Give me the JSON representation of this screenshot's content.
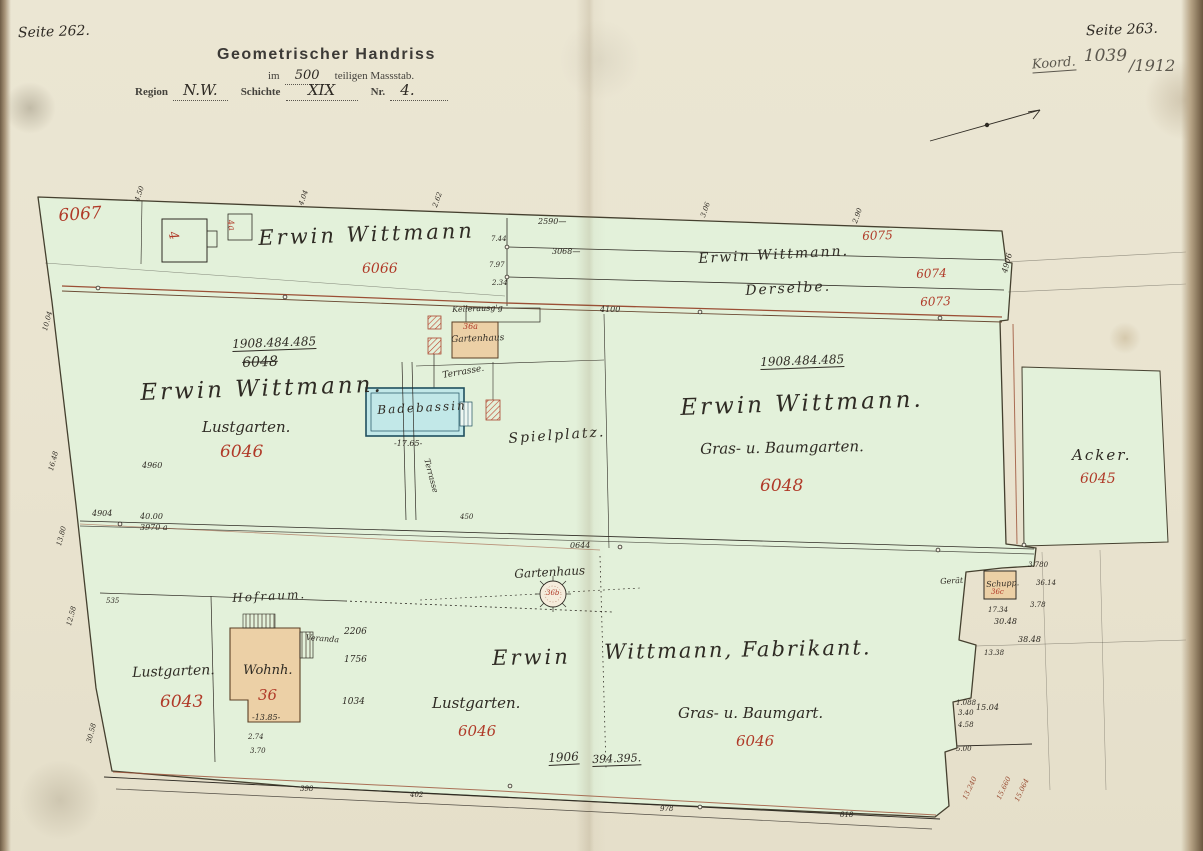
{
  "page": {
    "seite_left": "Seite 262.",
    "seite_right": "Seite 263.",
    "title": "Geometrischer Handriss",
    "subtitle_pre": "im",
    "subtitle_value": "500",
    "subtitle_post": "teiligen Massstab.",
    "region_label": "Region",
    "region_value": "N.W.",
    "schichte_label": "Schichte",
    "schichte_value": "XIX",
    "nr_label": "Nr.",
    "nr_value": "4.",
    "koord_label": "Koord.",
    "koord_num": "1039",
    "koord_denom": "/1912"
  },
  "colors": {
    "ink": "#2f2b24",
    "red": "#b03a28",
    "sepia": "#9b4f35",
    "pencil": "#5b574d",
    "green": "#e3f1da",
    "pool": "#c2e8e8",
    "tan": "#ecd0a6"
  },
  "map": {
    "north_arrow": "north-arrow",
    "labels": [
      {
        "t": "6067",
        "x": 58,
        "y": 208,
        "fs": 17,
        "c": "red",
        "r": -4
      },
      {
        "t": "4",
        "x": 178,
        "y": 230,
        "fs": 13,
        "c": "red",
        "r": 75
      },
      {
        "t": "4a",
        "x": 233,
        "y": 219,
        "fs": 9,
        "c": "red",
        "r": 78
      },
      {
        "t": "Erwin Wittmann",
        "x": 258,
        "y": 228,
        "fs": 21,
        "c": "ink",
        "r": -2,
        "ls": 3
      },
      {
        "t": "6066",
        "x": 362,
        "y": 262,
        "fs": 14,
        "c": "red"
      },
      {
        "t": "6075",
        "x": 862,
        "y": 230,
        "fs": 12,
        "c": "red",
        "r": -2
      },
      {
        "t": "Erwin Wittmann.",
        "x": 698,
        "y": 252,
        "fs": 14,
        "c": "ink",
        "r": -3,
        "ls": 2
      },
      {
        "t": "6074",
        "x": 916,
        "y": 268,
        "fs": 12,
        "c": "red",
        "r": -2
      },
      {
        "t": "Derselbe.",
        "x": 745,
        "y": 284,
        "fs": 14,
        "c": "ink",
        "r": -3,
        "ls": 2
      },
      {
        "t": "6073",
        "x": 920,
        "y": 296,
        "fs": 12,
        "c": "red",
        "r": -2
      },
      {
        "t": "2590—",
        "x": 538,
        "y": 218,
        "fs": 8,
        "c": "ink"
      },
      {
        "t": "3068—",
        "x": 552,
        "y": 248,
        "fs": 8,
        "c": "ink"
      },
      {
        "t": "7.44",
        "x": 491,
        "y": 236,
        "fs": 7,
        "c": "ink"
      },
      {
        "t": "7.97",
        "x": 489,
        "y": 262,
        "fs": 7,
        "c": "ink"
      },
      {
        "t": "2.34",
        "x": 492,
        "y": 280,
        "fs": 7,
        "c": "ink"
      },
      {
        "t": "4100",
        "x": 600,
        "y": 306,
        "fs": 8,
        "c": "ink"
      },
      {
        "t": "4906",
        "x": 1001,
        "y": 272,
        "fs": 8,
        "c": "ink",
        "r": -75
      },
      {
        "t": "1908.484.485",
        "x": 232,
        "y": 338,
        "fs": 12,
        "c": "ink",
        "u": 1,
        "r": -2
      },
      {
        "t": "6048",
        "x": 242,
        "y": 356,
        "fs": 14,
        "c": "ink",
        "st": 1,
        "r": -2
      },
      {
        "t": "Erwin Wittmann.",
        "x": 140,
        "y": 382,
        "fs": 23,
        "c": "ink",
        "r": -2,
        "ls": 3
      },
      {
        "t": "Lustgarten.",
        "x": 202,
        "y": 420,
        "fs": 15,
        "c": "ink"
      },
      {
        "t": "6046",
        "x": 220,
        "y": 444,
        "fs": 17,
        "c": "red"
      },
      {
        "t": "Kellerausg'g",
        "x": 452,
        "y": 306,
        "fs": 8,
        "c": "ink",
        "r": -2
      },
      {
        "t": "36a",
        "x": 463,
        "y": 323,
        "fs": 8,
        "c": "red"
      },
      {
        "t": "Gartenhaus",
        "x": 451,
        "y": 336,
        "fs": 9,
        "c": "ink",
        "r": -2
      },
      {
        "t": "Terrasse.",
        "x": 442,
        "y": 372,
        "fs": 9,
        "c": "ink",
        "r": -10
      },
      {
        "t": "Badebassin",
        "x": 377,
        "y": 404,
        "fs": 12,
        "c": "ink",
        "r": -3,
        "ls": 2
      },
      {
        "t": "-17.65-",
        "x": 394,
        "y": 440,
        "fs": 8,
        "c": "ink"
      },
      {
        "t": "Spielplatz.",
        "x": 508,
        "y": 432,
        "fs": 14,
        "c": "ink",
        "r": -4,
        "ls": 2
      },
      {
        "t": "Terrasse",
        "x": 430,
        "y": 458,
        "fs": 8,
        "c": "ink",
        "r": 75
      },
      {
        "t": "1908.484.485",
        "x": 760,
        "y": 356,
        "fs": 12,
        "c": "ink",
        "u": 1,
        "r": -2
      },
      {
        "t": "Erwin Wittmann.",
        "x": 680,
        "y": 397,
        "fs": 23,
        "c": "ink",
        "r": -2,
        "ls": 3
      },
      {
        "t": "Gras- u. Baumgarten.",
        "x": 700,
        "y": 442,
        "fs": 15,
        "c": "ink",
        "r": -1
      },
      {
        "t": "6048",
        "x": 760,
        "y": 478,
        "fs": 17,
        "c": "red"
      },
      {
        "t": "Acker.",
        "x": 1072,
        "y": 448,
        "fs": 15,
        "c": "ink",
        "ls": 2
      },
      {
        "t": "6045",
        "x": 1080,
        "y": 472,
        "fs": 14,
        "c": "red"
      },
      {
        "t": "4904",
        "x": 92,
        "y": 510,
        "fs": 8,
        "c": "ink"
      },
      {
        "t": "40.00",
        "x": 140,
        "y": 513,
        "fs": 8,
        "c": "ink"
      },
      {
        "t": "3970 a",
        "x": 140,
        "y": 524,
        "fs": 8,
        "c": "ink"
      },
      {
        "t": "4960",
        "x": 142,
        "y": 462,
        "fs": 8,
        "c": "ink"
      },
      {
        "t": "450",
        "x": 460,
        "y": 514,
        "fs": 7,
        "c": "ink"
      },
      {
        "t": "0644",
        "x": 570,
        "y": 542,
        "fs": 8,
        "c": "ink"
      },
      {
        "t": "Gartenhaus",
        "x": 514,
        "y": 568,
        "fs": 12,
        "c": "ink",
        "r": -3
      },
      {
        "t": "36b",
        "x": 546,
        "y": 590,
        "fs": 7,
        "c": "red"
      },
      {
        "t": "Hofraum.",
        "x": 232,
        "y": 592,
        "fs": 12,
        "c": "ink",
        "r": -3,
        "ls": 2
      },
      {
        "t": "535",
        "x": 106,
        "y": 598,
        "fs": 7,
        "c": "ink"
      },
      {
        "t": "2206",
        "x": 344,
        "y": 628,
        "fs": 9,
        "c": "ink"
      },
      {
        "t": "1756",
        "x": 344,
        "y": 656,
        "fs": 9,
        "c": "ink"
      },
      {
        "t": "1034",
        "x": 342,
        "y": 698,
        "fs": 9,
        "c": "ink"
      },
      {
        "t": "Wohnh.",
        "x": 243,
        "y": 664,
        "fs": 13,
        "c": "ink"
      },
      {
        "t": "36",
        "x": 258,
        "y": 688,
        "fs": 15,
        "c": "red"
      },
      {
        "t": "Veranda",
        "x": 306,
        "y": 634,
        "fs": 8,
        "c": "ink",
        "r": 4
      },
      {
        "t": "-13.85-",
        "x": 252,
        "y": 714,
        "fs": 8,
        "c": "ink"
      },
      {
        "t": "2.74",
        "x": 248,
        "y": 734,
        "fs": 7,
        "c": "ink"
      },
      {
        "t": "3.70",
        "x": 250,
        "y": 748,
        "fs": 7,
        "c": "ink"
      },
      {
        "t": "Lustgarten.",
        "x": 132,
        "y": 666,
        "fs": 14,
        "c": "ink",
        "r": -2
      },
      {
        "t": "6043",
        "x": 160,
        "y": 694,
        "fs": 17,
        "c": "red"
      },
      {
        "t": "Erwin",
        "x": 492,
        "y": 648,
        "fs": 21,
        "c": "ink",
        "r": -1,
        "ls": 3
      },
      {
        "t": "Wittmann, Fabrikant.",
        "x": 604,
        "y": 642,
        "fs": 21,
        "c": "ink",
        "r": -1,
        "ls": 2
      },
      {
        "t": "Lustgarten.",
        "x": 432,
        "y": 696,
        "fs": 15,
        "c": "ink"
      },
      {
        "t": "6046",
        "x": 458,
        "y": 724,
        "fs": 15,
        "c": "red"
      },
      {
        "t": "Gras- u. Baumgart.",
        "x": 678,
        "y": 706,
        "fs": 15,
        "c": "ink"
      },
      {
        "t": "6046",
        "x": 736,
        "y": 734,
        "fs": 15,
        "c": "red"
      },
      {
        "t": "1906",
        "x": 548,
        "y": 752,
        "fs": 12,
        "c": "ink",
        "u": 1,
        "r": -3
      },
      {
        "t": "394.395.",
        "x": 592,
        "y": 754,
        "fs": 11,
        "c": "ink",
        "u": 1,
        "r": -2
      },
      {
        "t": "Gerät",
        "x": 940,
        "y": 578,
        "fs": 8,
        "c": "ink",
        "r": -3
      },
      {
        "t": "Schupp.",
        "x": 986,
        "y": 581,
        "fs": 8,
        "c": "ink",
        "r": -3
      },
      {
        "t": "36c",
        "x": 991,
        "y": 589,
        "fs": 7,
        "c": "red"
      },
      {
        "t": "3.780",
        "x": 1028,
        "y": 562,
        "fs": 7,
        "c": "ink"
      },
      {
        "t": "36.14",
        "x": 1036,
        "y": 580,
        "fs": 7,
        "c": "ink"
      },
      {
        "t": "3.78",
        "x": 1030,
        "y": 602,
        "fs": 7,
        "c": "ink"
      },
      {
        "t": "17.34",
        "x": 988,
        "y": 607,
        "fs": 7,
        "c": "ink"
      },
      {
        "t": "30.48",
        "x": 994,
        "y": 618,
        "fs": 8,
        "c": "ink"
      },
      {
        "t": "38.48",
        "x": 1018,
        "y": 636,
        "fs": 8,
        "c": "ink"
      },
      {
        "t": "13.38",
        "x": 984,
        "y": 650,
        "fs": 7,
        "c": "ink"
      },
      {
        "t": "1.088",
        "x": 956,
        "y": 700,
        "fs": 7,
        "c": "ink"
      },
      {
        "t": "3.40",
        "x": 958,
        "y": 710,
        "fs": 7,
        "c": "ink"
      },
      {
        "t": "15.04",
        "x": 976,
        "y": 704,
        "fs": 8,
        "c": "ink"
      },
      {
        "t": "4.58",
        "x": 958,
        "y": 722,
        "fs": 7,
        "c": "ink"
      },
      {
        "t": "5.00",
        "x": 956,
        "y": 746,
        "fs": 7,
        "c": "ink"
      },
      {
        "t": "13.240",
        "x": 962,
        "y": 798,
        "fs": 7,
        "c": "sepia",
        "r": -65
      },
      {
        "t": "15.660",
        "x": 996,
        "y": 798,
        "fs": 7,
        "c": "sepia",
        "r": -65
      },
      {
        "t": "15.064",
        "x": 1014,
        "y": 800,
        "fs": 7,
        "c": "sepia",
        "r": -65
      },
      {
        "t": "4.50",
        "x": 134,
        "y": 200,
        "fs": 7,
        "c": "ink",
        "r": -70
      },
      {
        "t": "4.04",
        "x": 298,
        "y": 204,
        "fs": 7,
        "c": "ink",
        "r": -70
      },
      {
        "t": "2.62",
        "x": 432,
        "y": 206,
        "fs": 7,
        "c": "ink",
        "r": -70
      },
      {
        "t": "3.06",
        "x": 700,
        "y": 216,
        "fs": 7,
        "c": "ink",
        "r": -70
      },
      {
        "t": "2.90",
        "x": 852,
        "y": 222,
        "fs": 7,
        "c": "ink",
        "r": -70
      },
      {
        "t": "16.48",
        "x": 48,
        "y": 470,
        "fs": 7,
        "c": "ink",
        "r": -75
      },
      {
        "t": "13.80",
        "x": 56,
        "y": 545,
        "fs": 7,
        "c": "ink",
        "r": -75
      },
      {
        "t": "10.04",
        "x": 42,
        "y": 330,
        "fs": 7,
        "c": "ink",
        "r": -75
      },
      {
        "t": "12.58",
        "x": 66,
        "y": 625,
        "fs": 7,
        "c": "ink",
        "r": -75
      },
      {
        "t": "30.58",
        "x": 86,
        "y": 742,
        "fs": 7,
        "c": "ink",
        "r": -75
      },
      {
        "t": "398",
        "x": 300,
        "y": 786,
        "fs": 7,
        "c": "ink"
      },
      {
        "t": "402",
        "x": 410,
        "y": 792,
        "fs": 7,
        "c": "ink"
      },
      {
        "t": "978",
        "x": 660,
        "y": 806,
        "fs": 7,
        "c": "ink"
      },
      {
        "t": "818",
        "x": 840,
        "y": 812,
        "fs": 7,
        "c": "ink"
      }
    ]
  }
}
